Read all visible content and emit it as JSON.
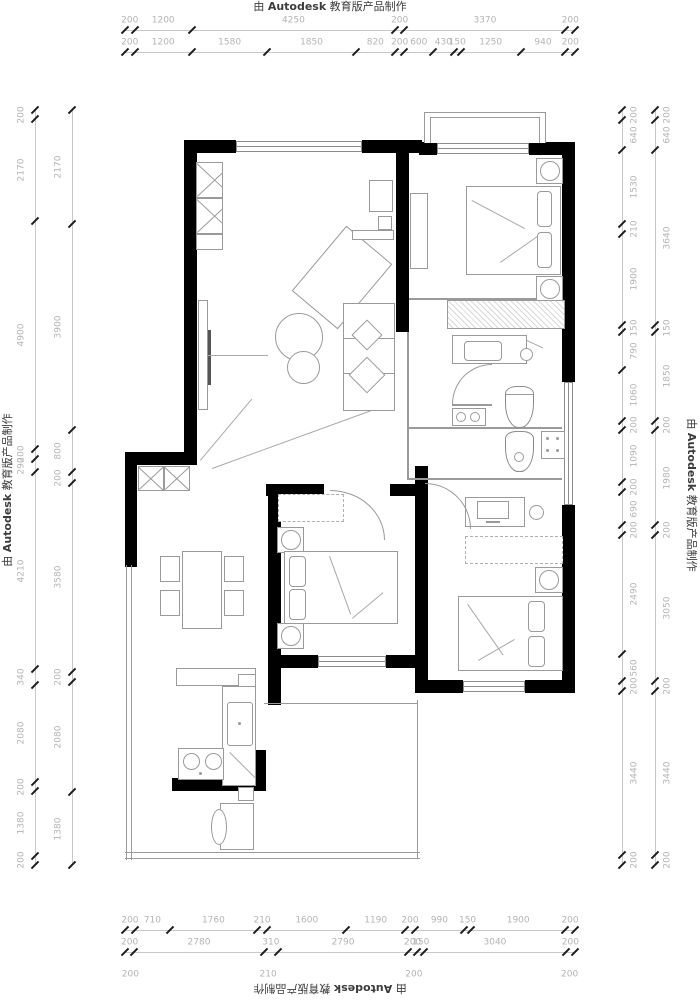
{
  "watermark": {
    "prefix": "由 ",
    "brand": "Autodesk",
    "suffix": " 教育版产品制作"
  },
  "dimensions": {
    "top": {
      "row1": [
        "200",
        "1200",
        "4250",
        "200",
        "3370",
        "200"
      ],
      "row2": [
        "200",
        "1200",
        "1580",
        "1850",
        "820",
        "200",
        "600",
        "430",
        "150",
        "1250",
        "940",
        "200"
      ]
    },
    "bottom": {
      "row1": [
        "200",
        "710",
        "1760",
        "210",
        "1600",
        "1190",
        "200",
        "990",
        "150",
        "1900",
        "200"
      ],
      "row2": [
        "200",
        "2780",
        "310",
        "2790",
        "200",
        "150",
        "3040",
        "200"
      ],
      "row3": [
        {
          "text": "200",
          "frac": 0.012
        },
        {
          "text": "210",
          "frac": 0.318
        },
        {
          "text": "200",
          "frac": 0.642
        },
        {
          "text": "200",
          "frac": 0.988
        }
      ]
    },
    "left": {
      "outer": [
        "200",
        "2170",
        "4900",
        "200",
        "290",
        "4210",
        "340",
        "2080",
        "200",
        "1380",
        "200"
      ],
      "inner": [
        "2170",
        "3900",
        "800",
        "200",
        "3580",
        "200",
        "2080",
        "1380"
      ]
    },
    "right": {
      "inner": [
        "200",
        "640",
        "1530",
        "210",
        "1900",
        "150",
        "790",
        "1060",
        "200",
        "1090",
        "200",
        "690",
        "200",
        "2490",
        "560",
        "200",
        "3440",
        "200"
      ],
      "outer": [
        "200",
        "640",
        "3640",
        "150",
        "1850",
        "200",
        "1980",
        "200",
        "3050",
        "200",
        "3440",
        "200"
      ]
    }
  },
  "colors": {
    "wall": "#000000",
    "furniture_line": "#9a9a9a",
    "dim_text": "#b4b4b4",
    "tick": "#1c1c1c"
  }
}
